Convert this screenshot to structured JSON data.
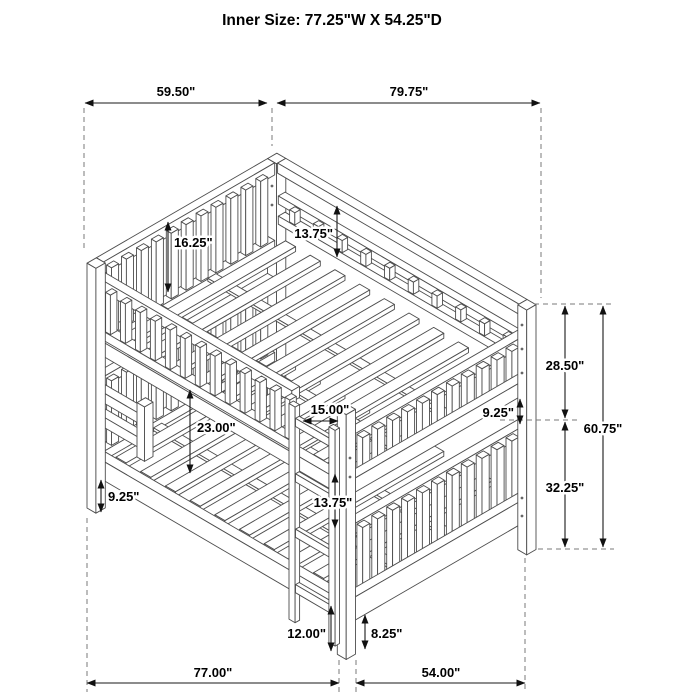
{
  "title": "Inner Size: 77.25\"W X 54.25\"D",
  "dimensions": {
    "top_depth": "59.50\"",
    "top_width": "79.75\"",
    "upper_headboard_panel_height": "16.25\"",
    "upper_back_rail_panel_height": "13.75\"",
    "upper_section_height": "28.50\"",
    "footboard_to_rail_gap": "9.25\"",
    "overall_height": "60.75\"",
    "lower_section_height": "32.25\"",
    "bunk_clearance": "23.00\"",
    "ladder_width": "15.00\"",
    "ladder_rung_spacing": "13.75\"",
    "side_rail_floor_clearance": "9.25\"",
    "first_rung_height": "12.00\"",
    "lower_frame_height": "8.25\"",
    "base_width": "77.00\"",
    "base_depth": "54.00\""
  }
}
